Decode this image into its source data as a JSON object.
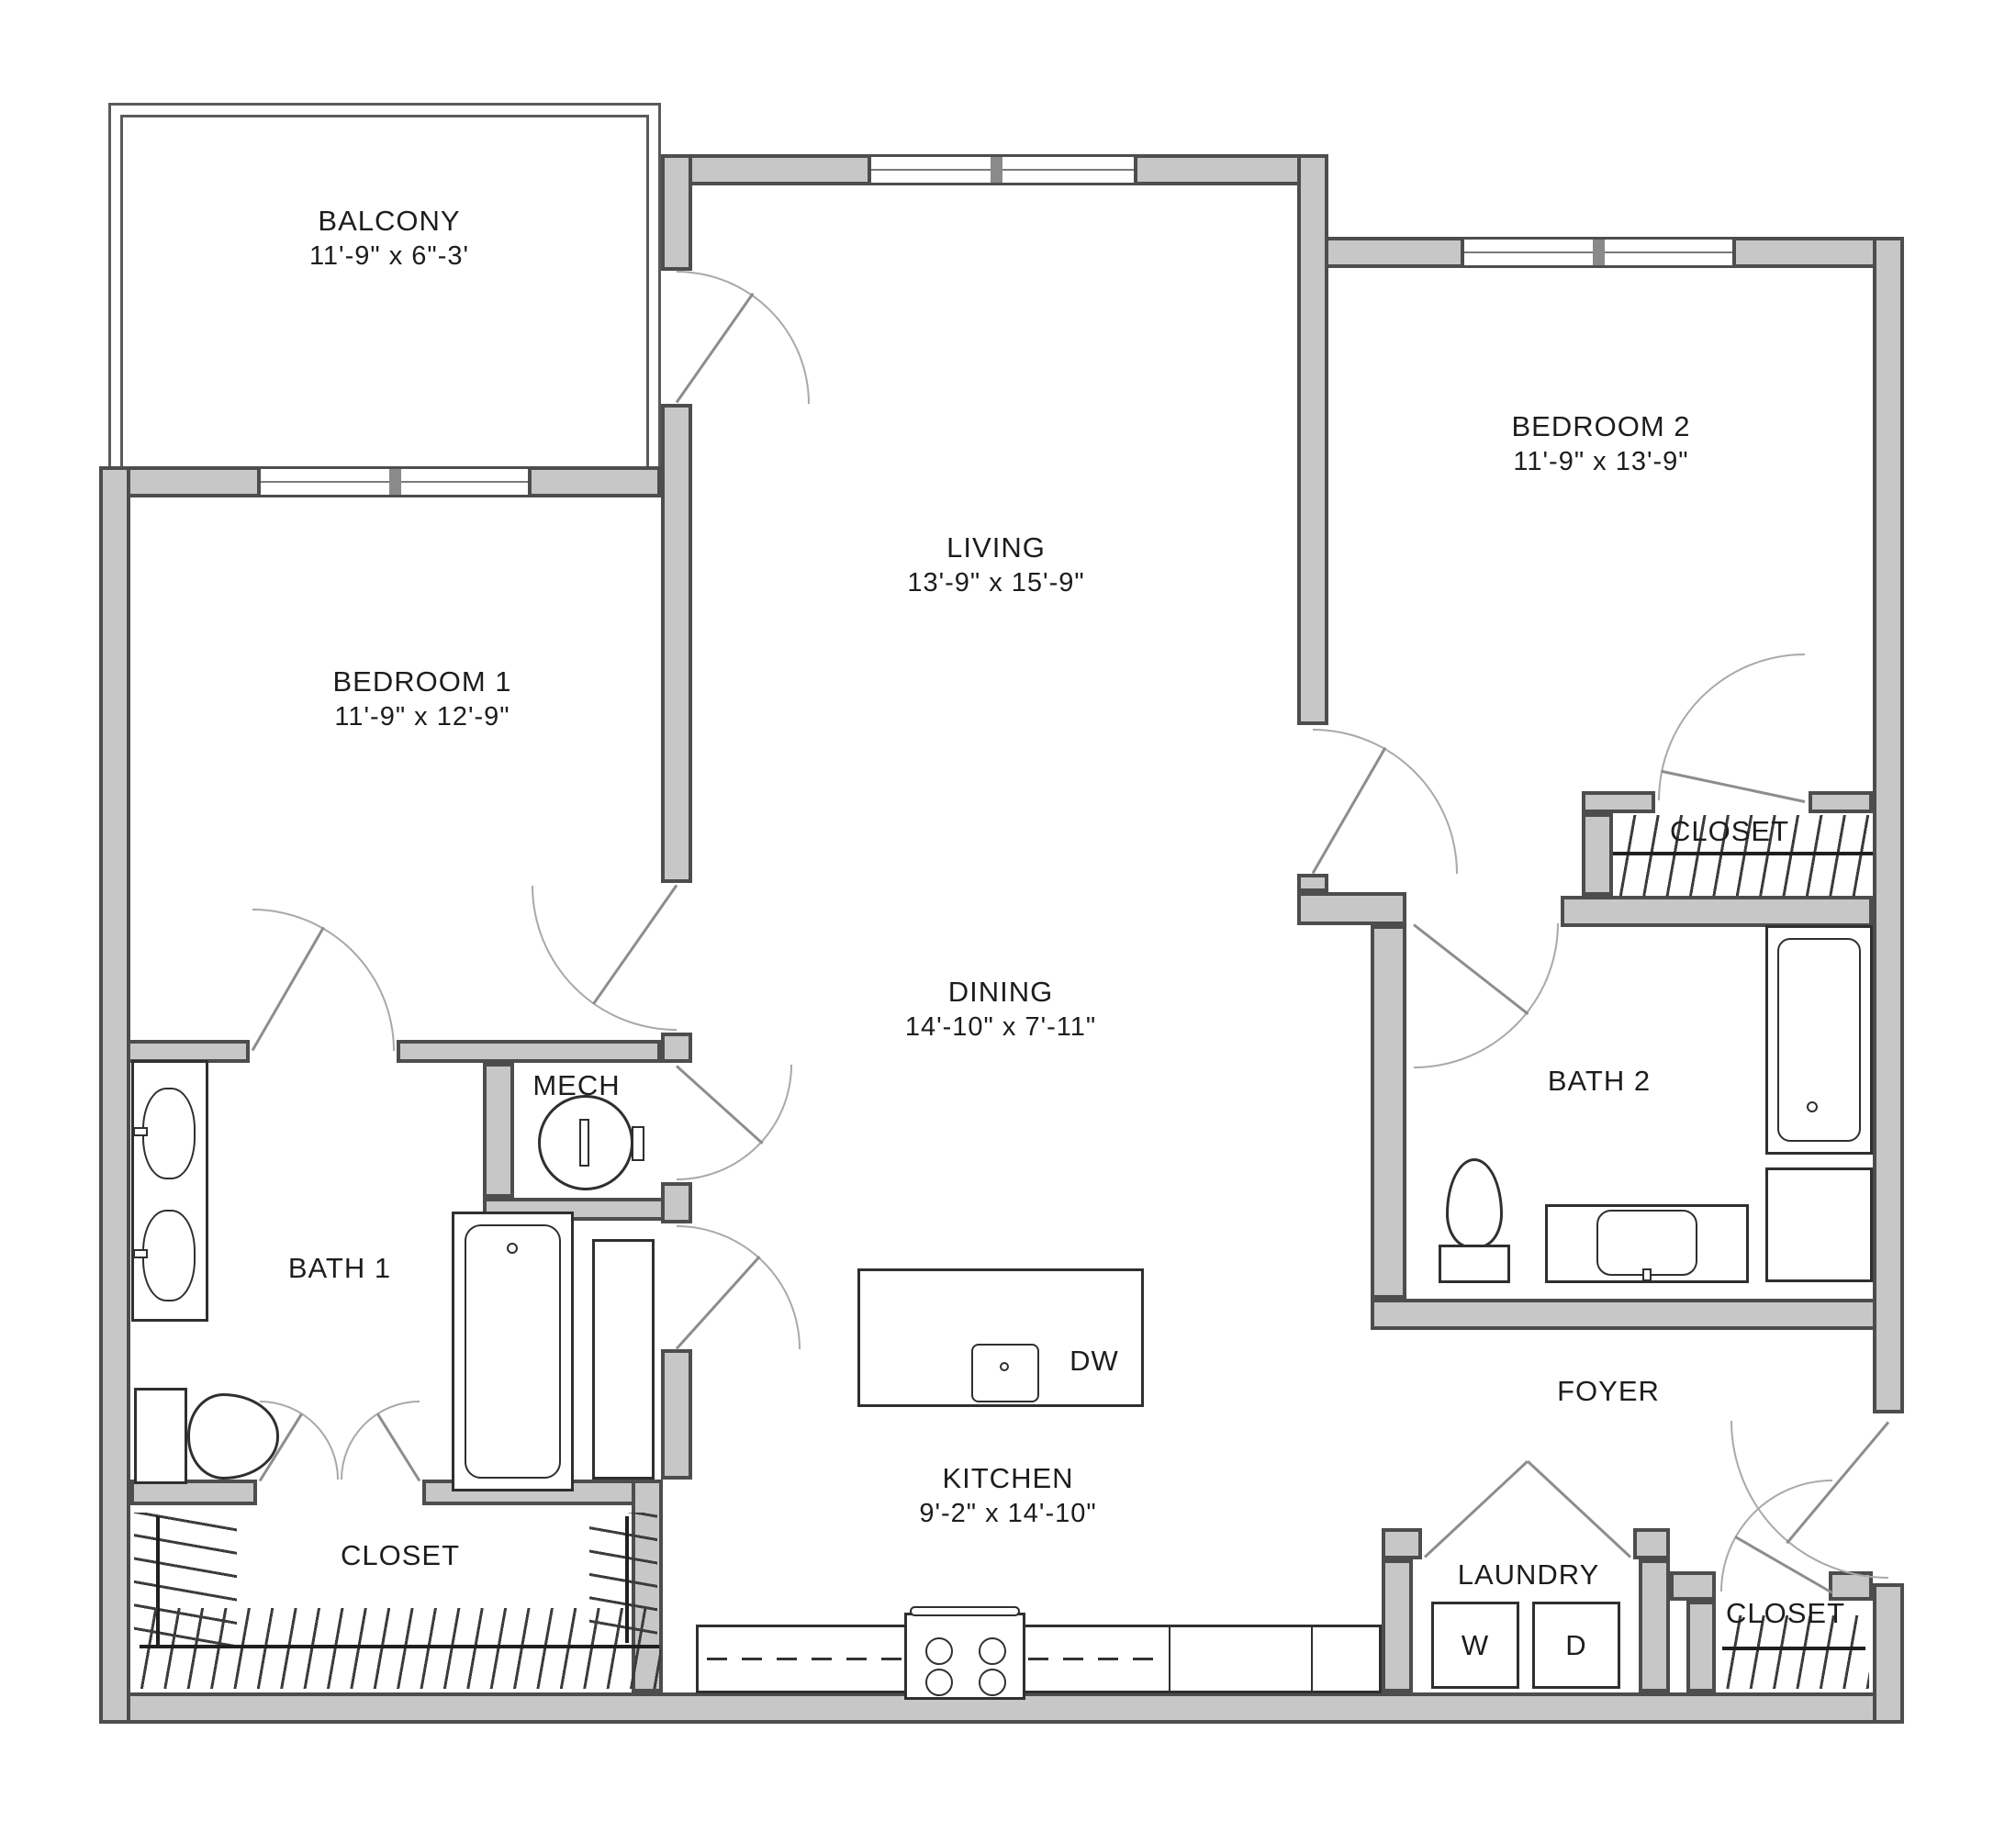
{
  "plan": {
    "rooms": [
      {
        "id": "balcony",
        "name": "BALCONY",
        "dims": "11'-9\" x 6\"-3'"
      },
      {
        "id": "bedroom-1",
        "name": "BEDROOM 1",
        "dims": "11'-9\" x 12'-9\""
      },
      {
        "id": "living",
        "name": "LIVING",
        "dims": "13'-9\" x 15'-9\""
      },
      {
        "id": "bedroom-2",
        "name": "BEDROOM 2",
        "dims": "11'-9\" x 13'-9\""
      },
      {
        "id": "dining",
        "name": "DINING",
        "dims": "14'-10\" x 7'-11\""
      },
      {
        "id": "kitchen",
        "name": "KITCHEN",
        "dims": "9'-2\" x 14'-10\""
      },
      {
        "id": "bath-1",
        "name": "BATH 1",
        "dims": ""
      },
      {
        "id": "bath-2",
        "name": "BATH 2",
        "dims": ""
      },
      {
        "id": "mech",
        "name": "MECH",
        "dims": ""
      },
      {
        "id": "foyer",
        "name": "FOYER",
        "dims": ""
      },
      {
        "id": "laundry",
        "name": "LAUNDRY",
        "dims": ""
      },
      {
        "id": "closet-bedroom2",
        "name": "CLOSET",
        "dims": ""
      },
      {
        "id": "closet-bedroom1",
        "name": "CLOSET",
        "dims": ""
      },
      {
        "id": "closet-foyer",
        "name": "CLOSET",
        "dims": ""
      }
    ],
    "appliances": {
      "washer": "W",
      "dryer": "D",
      "dishwasher": "DW"
    },
    "colors": {
      "wall_fill": "#c7c7c7",
      "wall_edge": "#4d4d4d",
      "fixture_line": "#2f2f2f",
      "door_line": "#a9a9a9",
      "text": "#1d1d1d",
      "background": "#ffffff"
    }
  }
}
